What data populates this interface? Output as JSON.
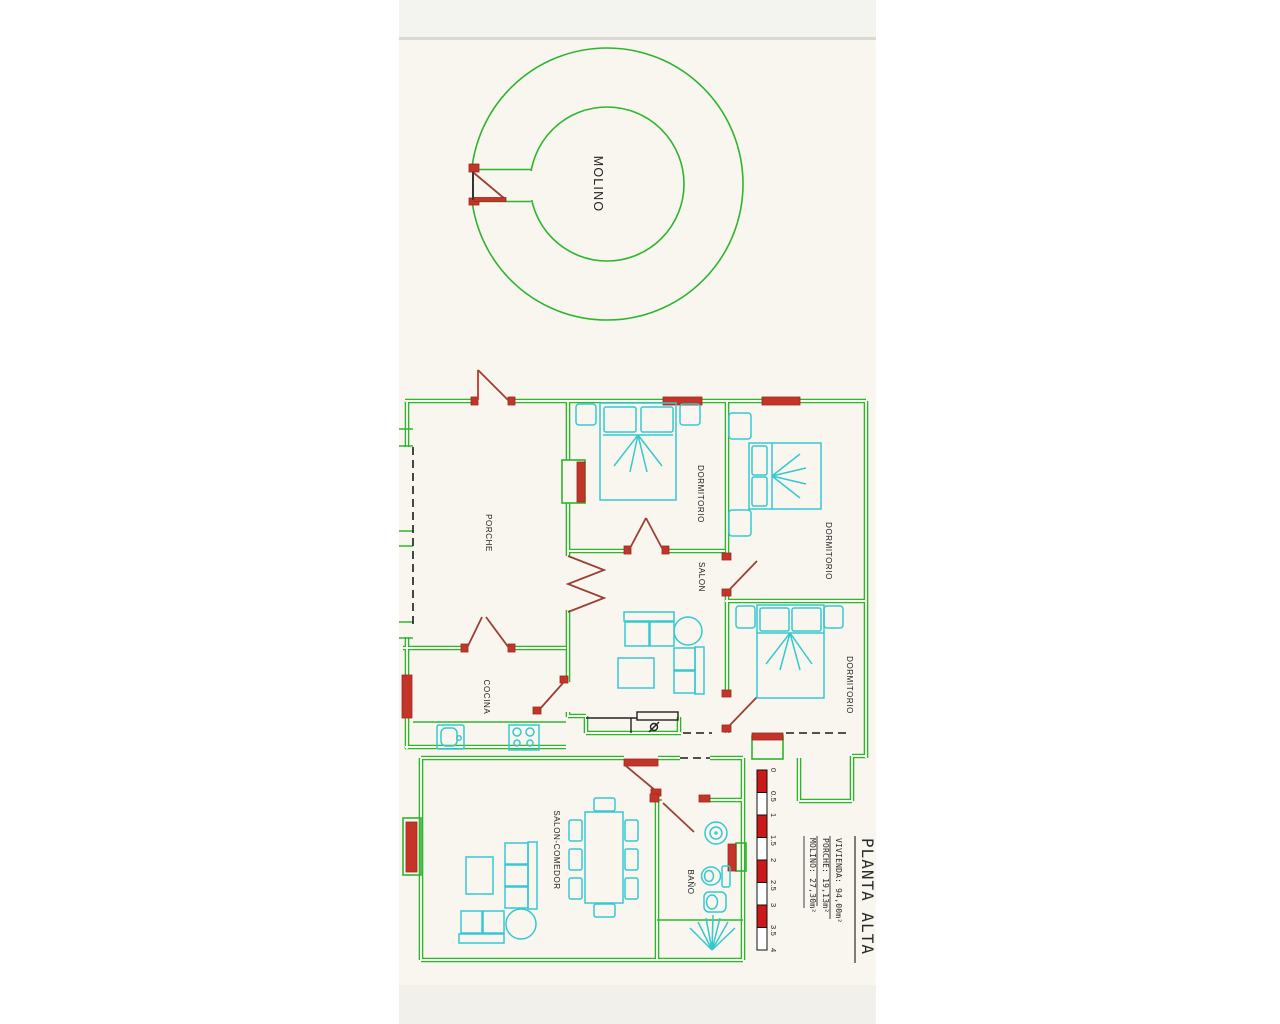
{
  "rooms": {
    "molino": "MOLINO",
    "porche": "PORCHE",
    "dormitorio_1": "DORMITORIO",
    "dormitorio_2": "DORMITORIO",
    "dormitorio_3": "DORMITORIO",
    "salon": "SALON",
    "cocina": "COCINA",
    "salon_comedor": "SALON-COMEDOR",
    "bano": "BAÑO"
  },
  "title_block": {
    "title": "PLANTA ALTA",
    "areas": [
      "VIVIENDA: 94,00m²",
      "PORCHE: 19,13m²",
      "MOLINO: 27,30m²"
    ]
  },
  "scale_bar": {
    "ticks": [
      "0",
      "0.5",
      "1",
      "1.5",
      "2",
      "2.5",
      "3",
      "3.5",
      "4"
    ]
  },
  "colors": {
    "wall_green": "#2eb52e",
    "door_red": "#c43428",
    "door_swing": "#9c4033",
    "furniture_cyan": "#35c8d0",
    "scale_red": "#cc1818",
    "paper_cream": "#f8f6ef"
  }
}
